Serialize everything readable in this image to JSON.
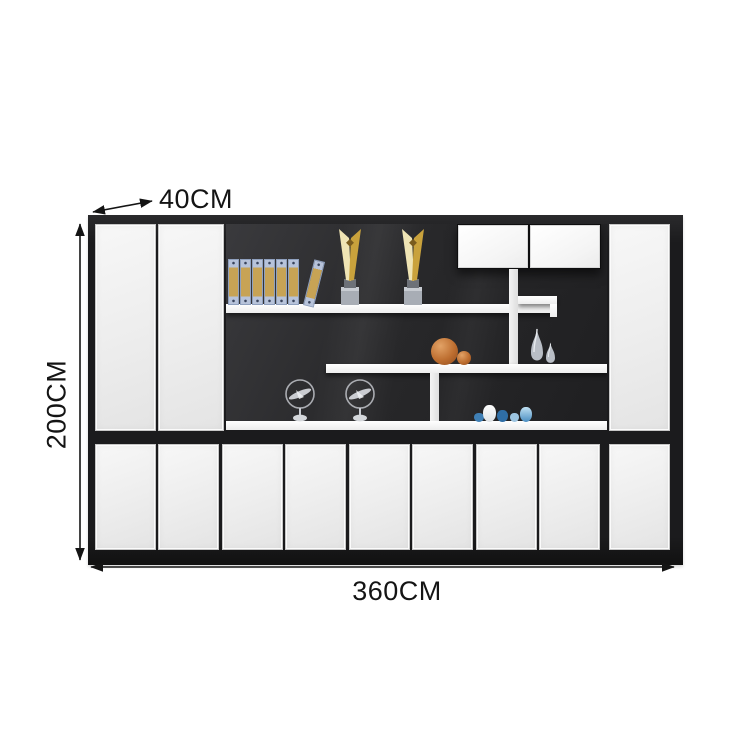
{
  "diagram": {
    "type": "furniture-dimension-diagram",
    "product": "white-black-office-display-cabinet",
    "dimensions": {
      "depth_label": "40CM",
      "height_label": "200CM",
      "width_label": "360CM"
    },
    "colors": {
      "background": "#ffffff",
      "annotation": "#141414",
      "frame": "#1b1b1d",
      "door": "#efefef",
      "display_bg": "#28282a",
      "shelf": "#fafafa",
      "binder_blue": "#b7c3da",
      "binder_tan": "#c7a355",
      "trophy_gold": "#c9a23c",
      "ball_orange": "#bd6e30",
      "decor_blue": "#4a8ec2"
    },
    "decor": {
      "binders_count": 7,
      "trophies_count": 2,
      "spiky_balls_count": 2,
      "vases_count": 2,
      "airplane_models_count": 2,
      "blue_ornaments_count": 5
    }
  }
}
